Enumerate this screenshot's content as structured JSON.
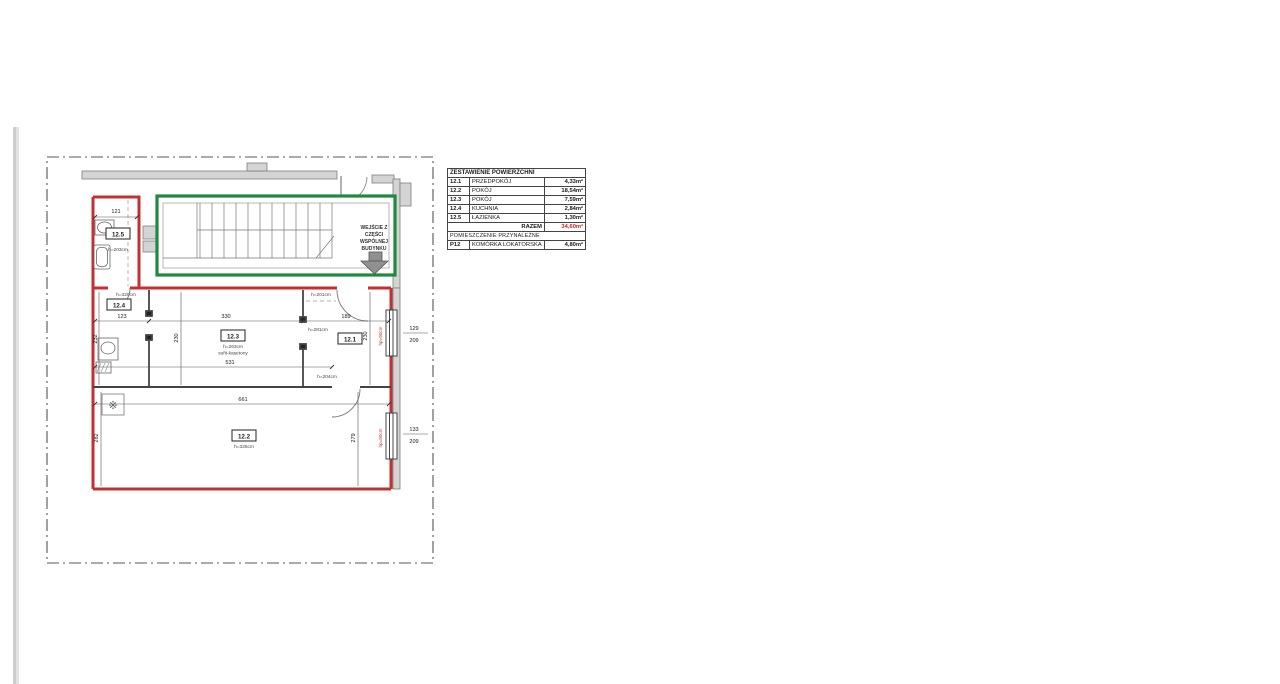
{
  "table": {
    "title": "ZESTAWIENIE POWIERZCHNI",
    "rows": [
      {
        "code": "12.1",
        "name": "PRZEDPOKÓJ",
        "area": "4,33m²"
      },
      {
        "code": "12.2",
        "name": "POKÓJ",
        "area": "18,54m²"
      },
      {
        "code": "12.3",
        "name": "POKÓJ",
        "area": "7,59m²"
      },
      {
        "code": "12.4",
        "name": "KUCHNIA",
        "area": "2,84m²"
      },
      {
        "code": "12.5",
        "name": "ŁAZIENKA",
        "area": "1,30m²"
      }
    ],
    "total_label": "RAZEM",
    "total_value": "34,60m²",
    "section2": "POMIESZCZENIE PRZYNALEŻNE",
    "extra_row": {
      "code": "P12",
      "name": "KOMÓRKA LOKATORSKA",
      "area": "4,80m²"
    },
    "accent_color": "#cc2222"
  },
  "plan": {
    "entrance": [
      "WEJŚCIE Z",
      "CZĘŚCI",
      "WSPÓLNEJ",
      "BUDYNKU"
    ],
    "labels": {
      "r125": "12.5",
      "r125_h": "h=203cm",
      "bath_width": "121",
      "r124": "12.4",
      "r124_h": "h=320cm",
      "r124_w": "123",
      "r123": "12.3",
      "r123_h": "h=263cm",
      "r123_ceiling": "sufit-kasetony",
      "r123_w": "330",
      "r121": "12.1",
      "r121_h": "h=281cm",
      "r121_w": "189",
      "entry_h": "h=201cm",
      "r122": "12.2",
      "r122_h": "h=325cm",
      "r122_w": "661",
      "r122_hl": "282",
      "r122_hr": "279",
      "door_h": "h=204cm",
      "band_h_left": "232",
      "band_h_mid": "230",
      "band_h_right": "230",
      "span_inner": "531",
      "win1_w": "129",
      "win1_h": "209",
      "win2_w": "133",
      "win2_h": "209",
      "sill1": "hp=90cm",
      "sill2": "hp=90cm",
      "vent_symbol": "※"
    },
    "colors": {
      "apartment_outline": "#c43030",
      "common_outline": "#1e8a3c"
    }
  }
}
